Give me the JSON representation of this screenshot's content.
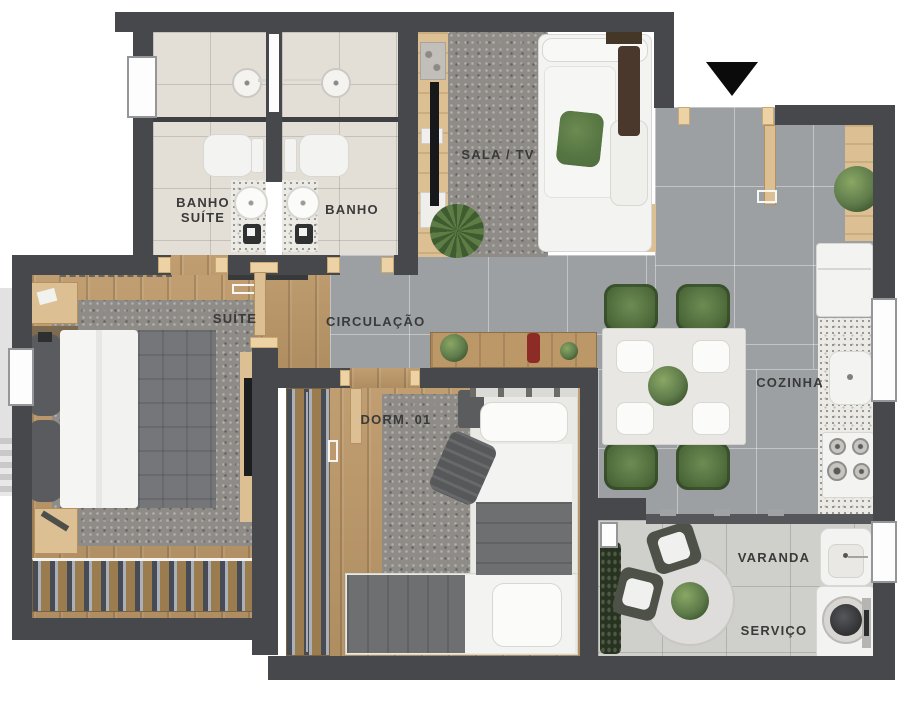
{
  "plan": {
    "rooms": {
      "banho_suite": "BANHO\nSUÍTE",
      "banho": "BANHO",
      "sala_tv": "SALA / TV",
      "suite": "SUÍTE",
      "circulacao": "CIRCULAÇÃO",
      "dorm_01": "DORM. 01",
      "cozinha": "COZINHA",
      "varanda": "VARANDA",
      "servico": "SERVIÇO"
    },
    "icons": {
      "entrance_arrow": "triangle-down-black"
    },
    "colors": {
      "wall": "#47484b",
      "wood": "#bc9869",
      "woodLight": "#dcc094",
      "tile": "#9da0a2",
      "tileLight": "#cfcfcb",
      "bathFloor": "#e3dfd7",
      "rug": "#8f8c88",
      "granite": "#eceae4",
      "green": "#5d7a4a",
      "greenDark": "#39492f",
      "fabricGray": "#6e7072",
      "furnWhite": "#f3f3f1",
      "labelColor": "#3a3a3a"
    }
  }
}
